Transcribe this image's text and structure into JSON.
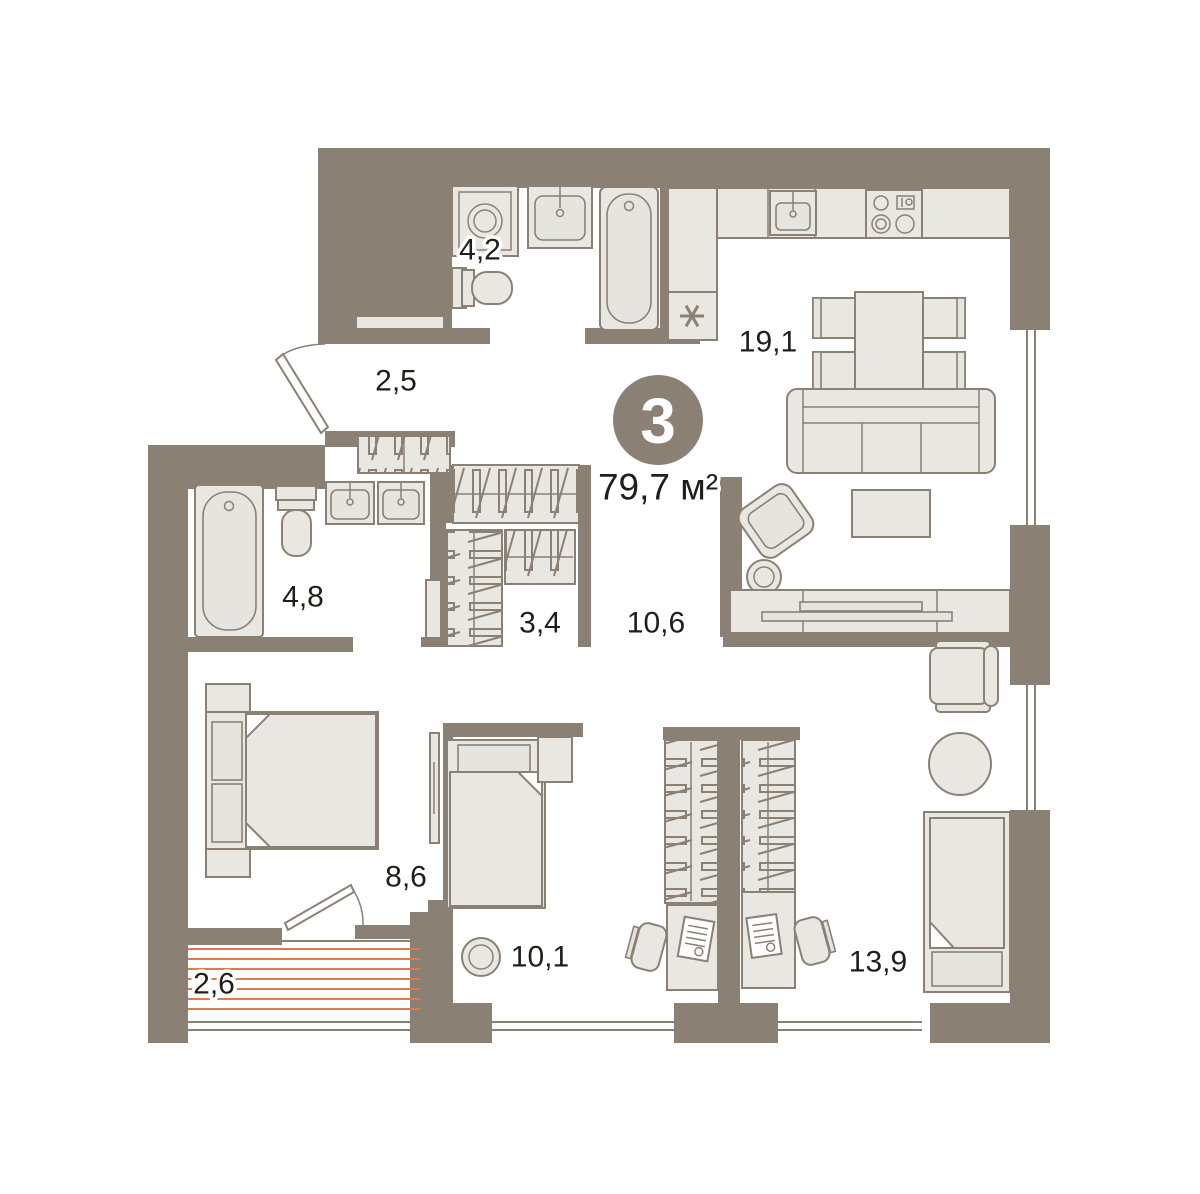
{
  "plan": {
    "badge": {
      "rooms_count": "3",
      "total_area": "79,7 м²"
    },
    "rooms": {
      "entry_hall": "2,5",
      "bathroom_small": "4,2",
      "kitchen_living": "19,1",
      "bathroom_large": "4,8",
      "wardrobe": "3,4",
      "hallway": "10,6",
      "bedroom": "8,6",
      "balcony": "2,6",
      "child_room_1": "10,1",
      "child_room_2": "13,9"
    },
    "colors": {
      "wall": "#8b8074",
      "furniture": "#e9e7e2",
      "balcony_hatch": "#dc7950",
      "text": "#1e1e1c"
    }
  }
}
